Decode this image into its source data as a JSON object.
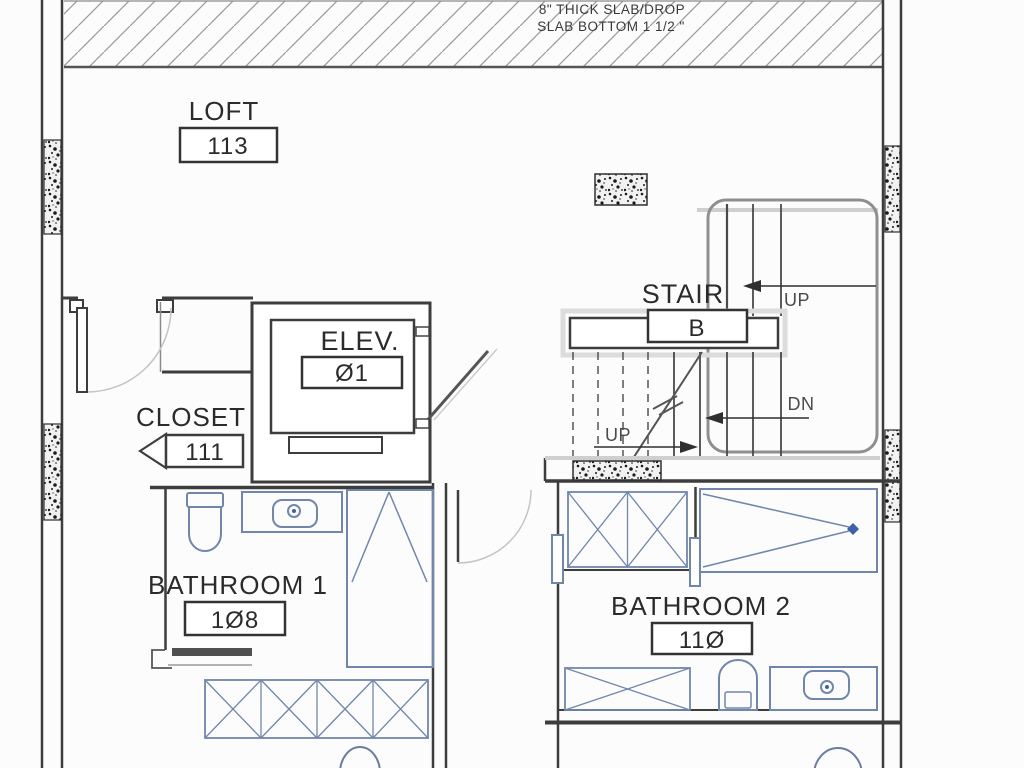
{
  "annotations": {
    "slab_note_line1": "8\" THICK SLAB/DROP",
    "slab_note_line2": "SLAB BOTTOM 1 1/2 \"",
    "up_top": "UP",
    "down": "DN",
    "up_bottom": "UP"
  },
  "rooms": {
    "loft": {
      "name": "LOFT",
      "number": "113"
    },
    "elevator": {
      "name": "ELEV.",
      "number": "Ø1"
    },
    "closet": {
      "name": "CLOSET",
      "number": "111"
    },
    "stair": {
      "name": "STAIR",
      "number": "B"
    },
    "bathroom1": {
      "name": "BATHROOM 1",
      "number": "1Ø8"
    },
    "bathroom2": {
      "name": "BATHROOM 2",
      "number": "11Ø"
    }
  },
  "colors": {
    "wall_line": "#3d3d3d",
    "fixture_blue": "#7186ab",
    "accent_blue": "#3f5fa8",
    "light_grey": "#c4c4c4",
    "hatch_grey": "#9e9e9e"
  }
}
